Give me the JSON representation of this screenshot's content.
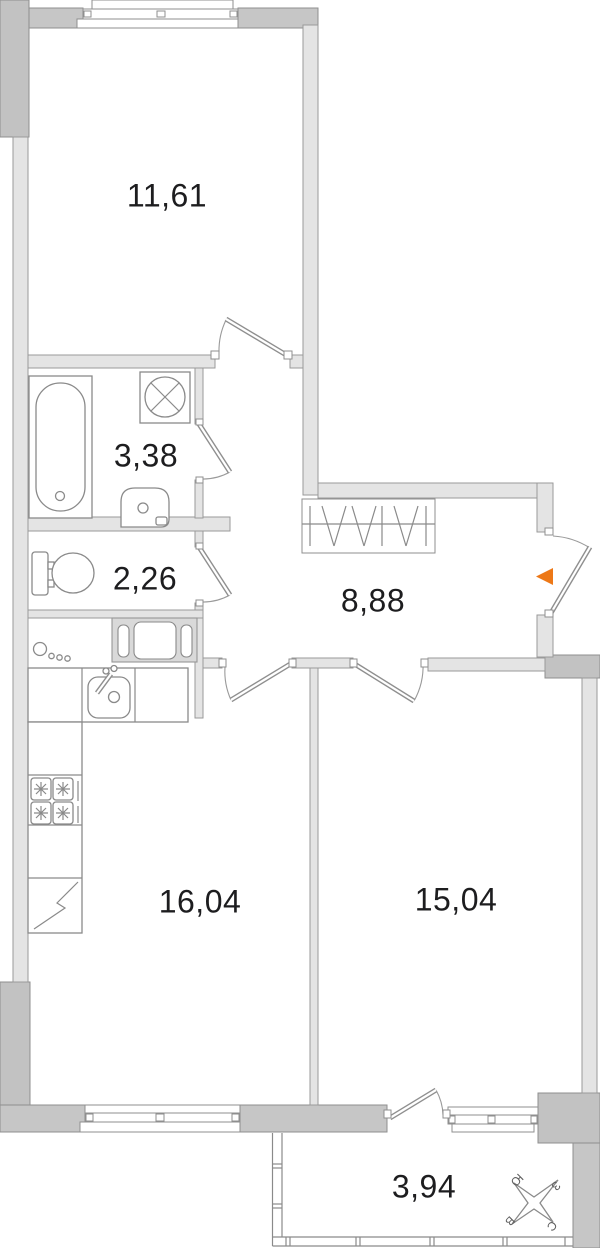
{
  "plan": {
    "title": "apartment floor plan",
    "rooms": [
      {
        "id": "room-11-61",
        "area": "11,61"
      },
      {
        "id": "bathroom",
        "area": "3,38"
      },
      {
        "id": "wc",
        "area": "2,26"
      },
      {
        "id": "hallway",
        "area": "8,88"
      },
      {
        "id": "kitchen",
        "area": "16,04"
      },
      {
        "id": "room-15-04",
        "area": "15,04"
      },
      {
        "id": "balcony",
        "area": "3,94"
      }
    ],
    "compass": {
      "south": "Ю",
      "west": "З",
      "east": "В",
      "north": "С"
    },
    "colors": {
      "accent": "#ed7817",
      "wall_exterior": "#c6c6c6",
      "wall_interior": "#e4e4e4",
      "line": "#8a8a8a",
      "text": "#1d1d1f"
    },
    "icons": [
      "bathtub",
      "washing-machine",
      "wash-basin",
      "toilet",
      "kitchen-sink",
      "stove",
      "fridge",
      "wardrobe",
      "vent-shaft",
      "gas-meter",
      "window",
      "door",
      "compass-rose",
      "entrance-arrow"
    ]
  }
}
